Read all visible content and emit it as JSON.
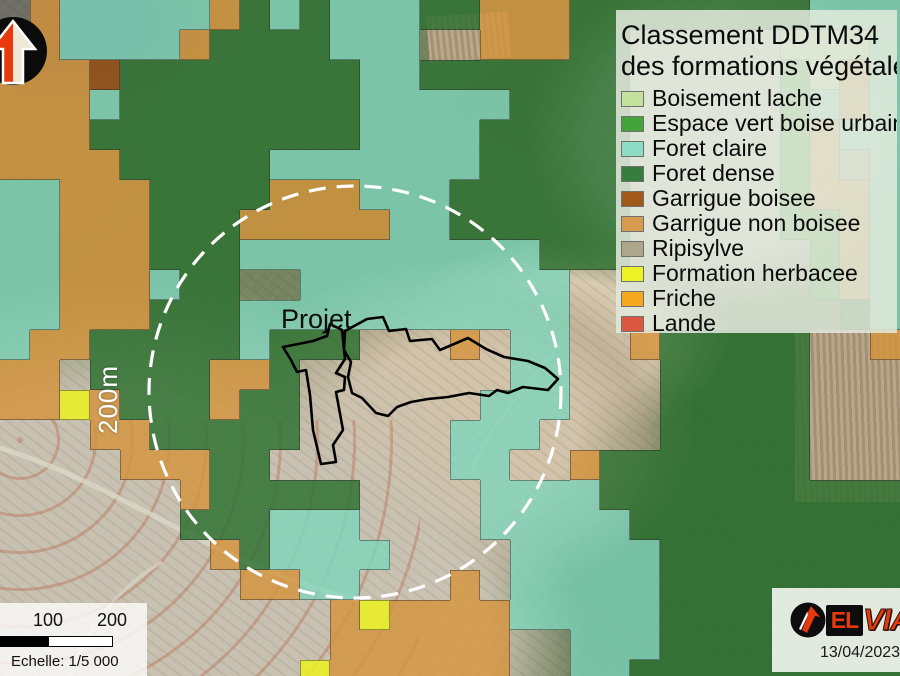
{
  "map": {
    "projet_label": "Projet",
    "buffer_label": "200m"
  },
  "legend": {
    "title_line1": "Classement DDTM34",
    "title_line2": "des formations végétales",
    "items": [
      {
        "label": "Boisement lache",
        "color": "#c5e19e"
      },
      {
        "label": "Espace vert boise urbain",
        "color": "#45a33c"
      },
      {
        "label": "Foret claire",
        "color": "#8edcc6"
      },
      {
        "label": "Foret dense",
        "color": "#377d3e"
      },
      {
        "label": "Garrigue boisee",
        "color": "#a1581b"
      },
      {
        "label": "Garrigue non boisee",
        "color": "#d89a4e"
      },
      {
        "label": "Ripisylve",
        "color": "#aca78a"
      },
      {
        "label": "Formation herbacee",
        "color": "#edf327"
      },
      {
        "label": "Friche",
        "color": "#f3a81f"
      },
      {
        "label": "Lande",
        "color": "#dc5740"
      }
    ]
  },
  "scalebar": {
    "tick_100": "100",
    "tick_200": "200 m",
    "echelle": "Echelle: 1/5 000"
  },
  "logo": {
    "el": "EL",
    "via": "VIA",
    "date": "13/04/2023"
  },
  "icons": {
    "north_arrow": "north-arrow-icon",
    "elvia_arrow": "arrow-up-right-icon"
  },
  "colors": {
    "buffer_circle": "#ffffff",
    "project_outline": "#000000",
    "legend_bg": "rgba(226,233,220,0.86)",
    "logo_red": "#e8380d"
  },
  "grid": {
    "cell_px": 30,
    "palette": {
      "D": "rgba(44,112,47,0.82)",
      "C": "rgba(126,214,188,0.78)",
      "G": "rgba(213,148,59,0.80)",
      "B": "rgba(148,77,20,0.85)",
      "Y": "rgba(235,240,35,0.88)",
      "L": "rgba(197,225,158,0.85)",
      "E": "rgba(74,165,63,0.80)",
      "R": "rgba(172,167,138,0.85)"
    },
    "rows": [
      ".GCCCCCGDCDCCCDDGGGDDDDDDDDCCC",
      "GGCCCCGDDDDCCC..GGGDD.....LLLC",
      "GGGBDDDDDDDDCCDDDDDDD.....ELGC",
      "GGGCDDDDDDDDCCCCCDDDD.....ECGC",
      "GGGDDDDDDDDDCCCCDDDDD.....EGCC",
      "GGGGDDDDDCCCCCCCDDDDD.....EGRC",
      "CCGGGDDDDGGGCCCDDDDDD.....EGGC",
      "CCGGGDDDGGGGGCCDDDDDD.....EEGC",
      "CCGGGDDDCCCCCCCCCCDDD......EGC",
      "CCGGGCDD..CCCCCCCCC........EGC",
      "CCGGGDDDCCCCCCCCCCC.........DC",
      "CGGDDDDDCDDD...G.CC..GDDDDD..G",
      "GG.DDDDGGD.......CC...DDDDD...",
      "GGYGDDDGDD......CCC...DDDDD...",
      "...GGDDDDD.....CCC....DDDDD...",
      "....GGGDD......CC..GDDDDDDD...",
      "......GDDDDD....CCCCDDDDDDDDDD",
      "......DDDCCC....CCCCCDDDDDDDDD",
      ".......GDCCCC....CCCCCDDDDDDDD",
      "........GGCC...G.CCCCCDDDDDDDD",
      "...........GYGGGGCCCCCDDDDDDDD",
      "...........GGGGGG..CCCDDDDDDDD",
      "..........YGGGGGG..CCDDDDDDDDD"
    ]
  }
}
